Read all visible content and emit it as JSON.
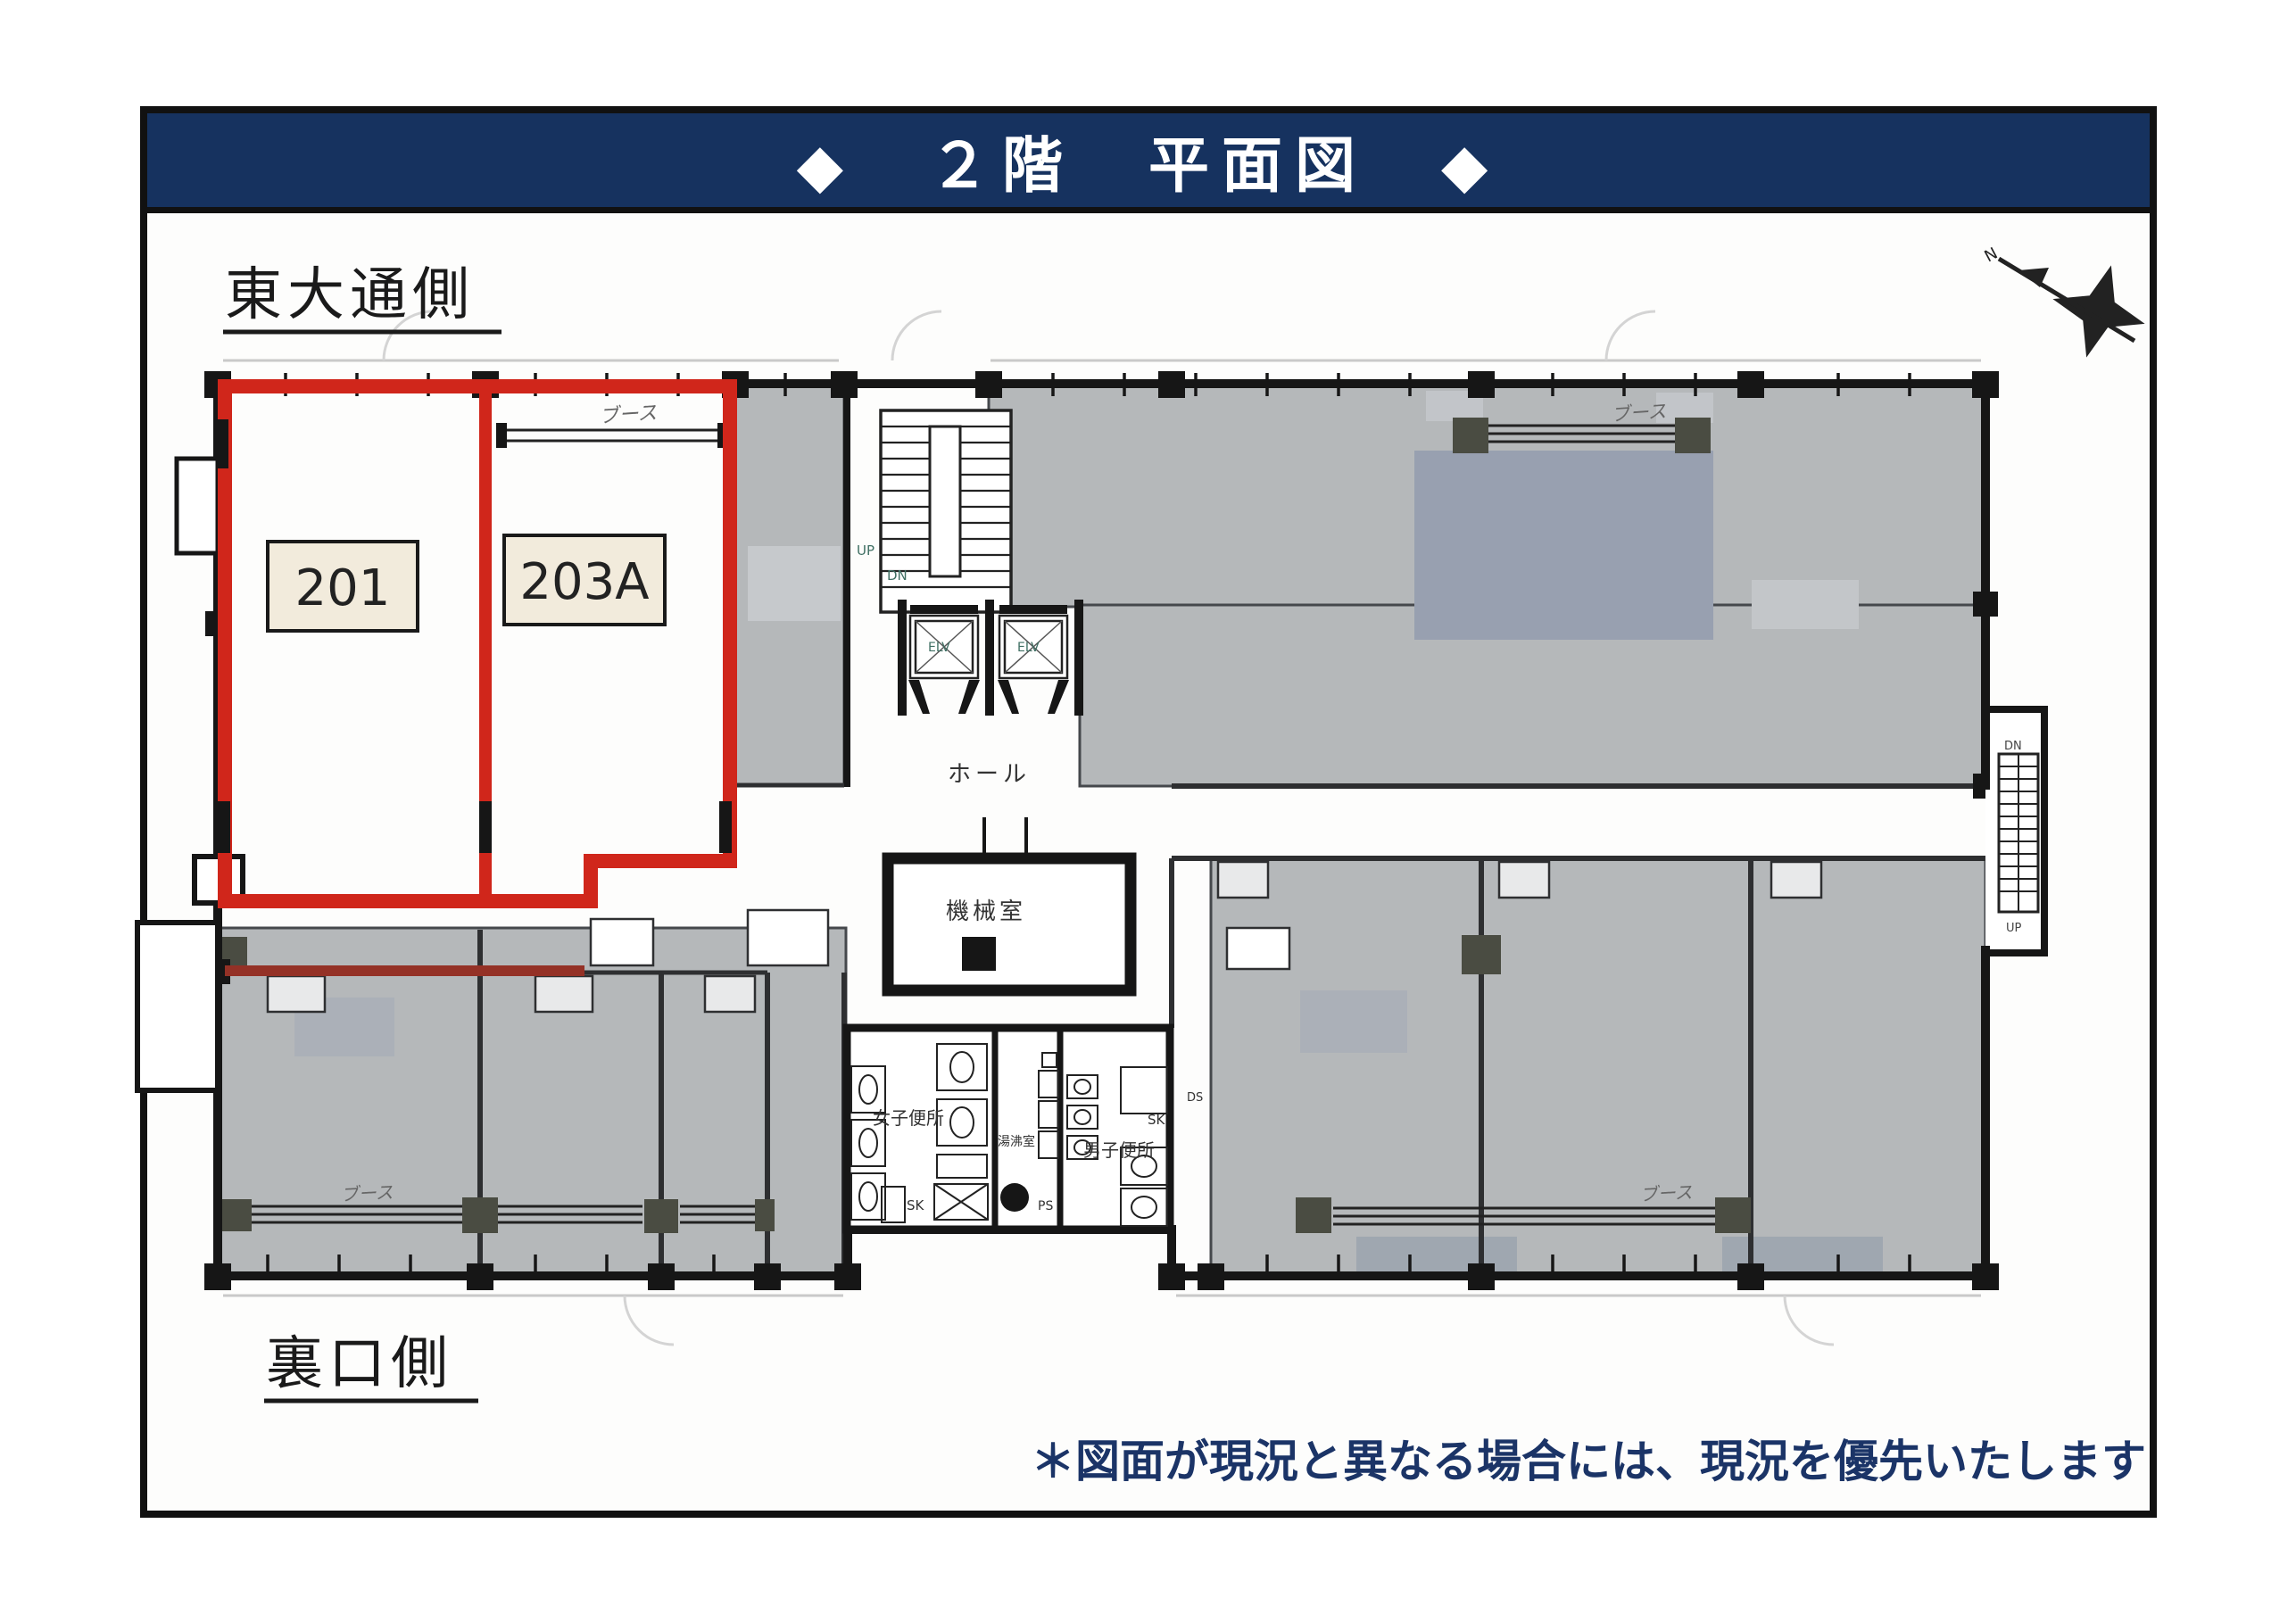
{
  "header": {
    "title": "◆　２階　平面図　◆"
  },
  "sides": {
    "east": "東大通側",
    "back": "裏口側"
  },
  "note": {
    "text": "＊図面が現況と異なる場合には、現況を優先いたします"
  },
  "rooms": {
    "r201": "201",
    "r203a": "203A",
    "hall": "ホール",
    "machine": "機械室",
    "womens": "女子便所",
    "mens": "男子便所",
    "hot_water": "湯沸室",
    "sk": "SK",
    "ps": "PS",
    "ds": "DS",
    "booth": "ブース"
  },
  "stairs": {
    "up": "UP",
    "dn": "DN"
  },
  "elevator": {
    "label": "ELV"
  },
  "compass": {
    "north": "N"
  },
  "colors": {
    "header_navy": "#16325f",
    "note_navy": "#1b3467",
    "outline_red": "#d0261b",
    "corridor_red": "#943126",
    "room_gray": "#b5b8ba",
    "booth_gray": "#98a0b0",
    "column_olive": "#4a4c42",
    "wall_black": "#1a1a1a",
    "label_beige": "#f2ebdc"
  }
}
